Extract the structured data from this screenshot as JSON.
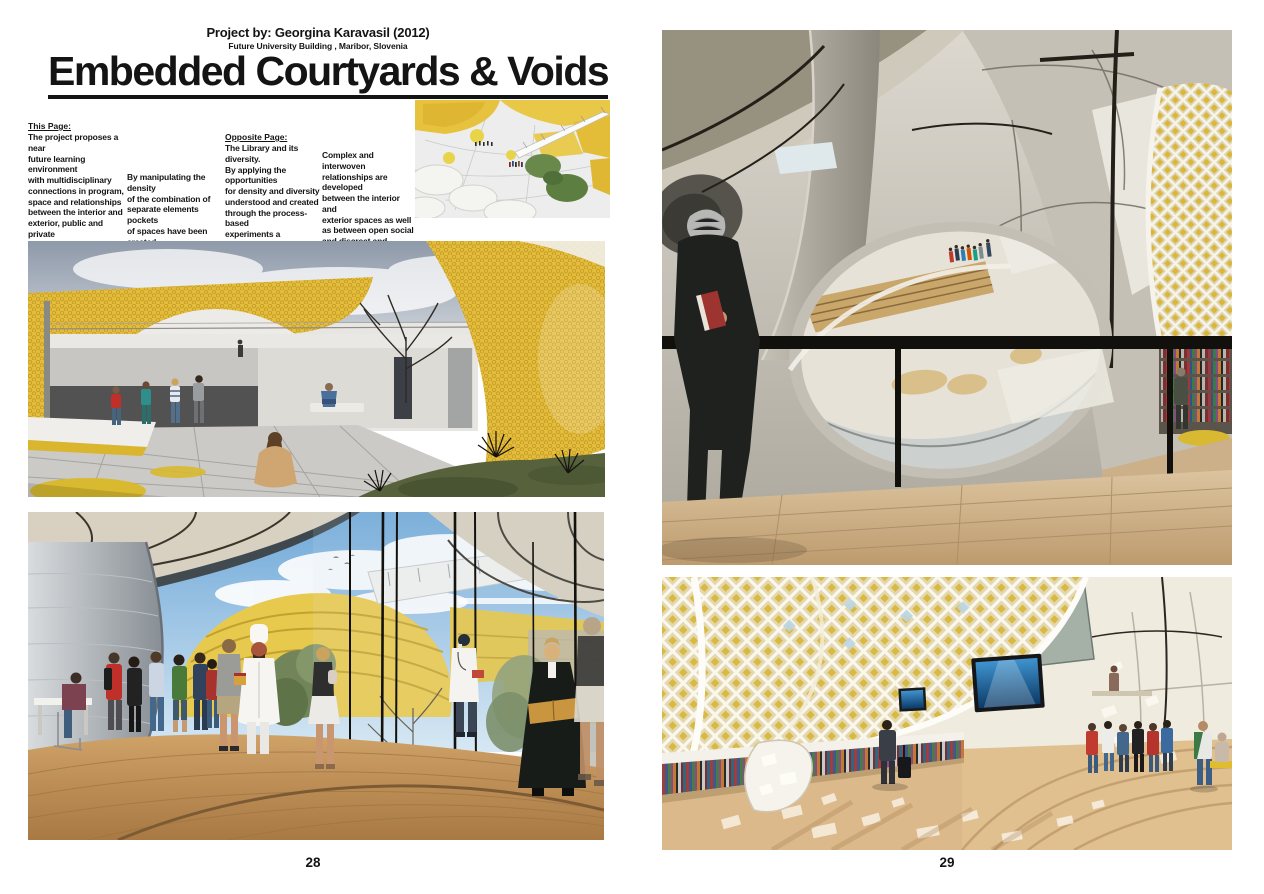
{
  "header": {
    "byline": "Project by: Georgina Karavasil (2012)",
    "subline": "Future University Building , Maribor, Slovenia",
    "title": "Embedded Courtyards & Voids"
  },
  "intro": {
    "this_page_heading": "This Page:",
    "this_page_text": "The project proposes a near\nfuture learning environment\nwith multidisciplinary\nconnections in program,\nspace and relationships\nbetween the interior and\nexterior, public and private\nspaces as simultaneously,\ndistinct, blurred and merged.",
    "this_page_text2": "By manipulating the density\nof the combination of\nseparate elements pockets\nof spaces have been created\nwithin different volumes.",
    "opposite_page_heading": "Opposite Page:",
    "opposite_page_text": "The Library and its diversity.\nBy applying the opportunities\nfor density and diversity\nunderstood and created\nthrough the process-based\nexperiments a proposition for\nfuture learning environments\nis explored.",
    "opposite_page_text2": "Complex and interwoven\nrelationships are developed\nbetween the interior and\nexterior spaces as well\nas between open social\nand discreet and defined\nlearning spaces."
  },
  "footer": {
    "left_page_number": "28",
    "right_page_number": "29"
  },
  "palette": {
    "accent_yellow": "#e4bd3c",
    "wood_brown": "#c0914f",
    "sky_blue": "#7fb2dc",
    "sky_grey": "#98a2b0",
    "ink": "#141414"
  }
}
